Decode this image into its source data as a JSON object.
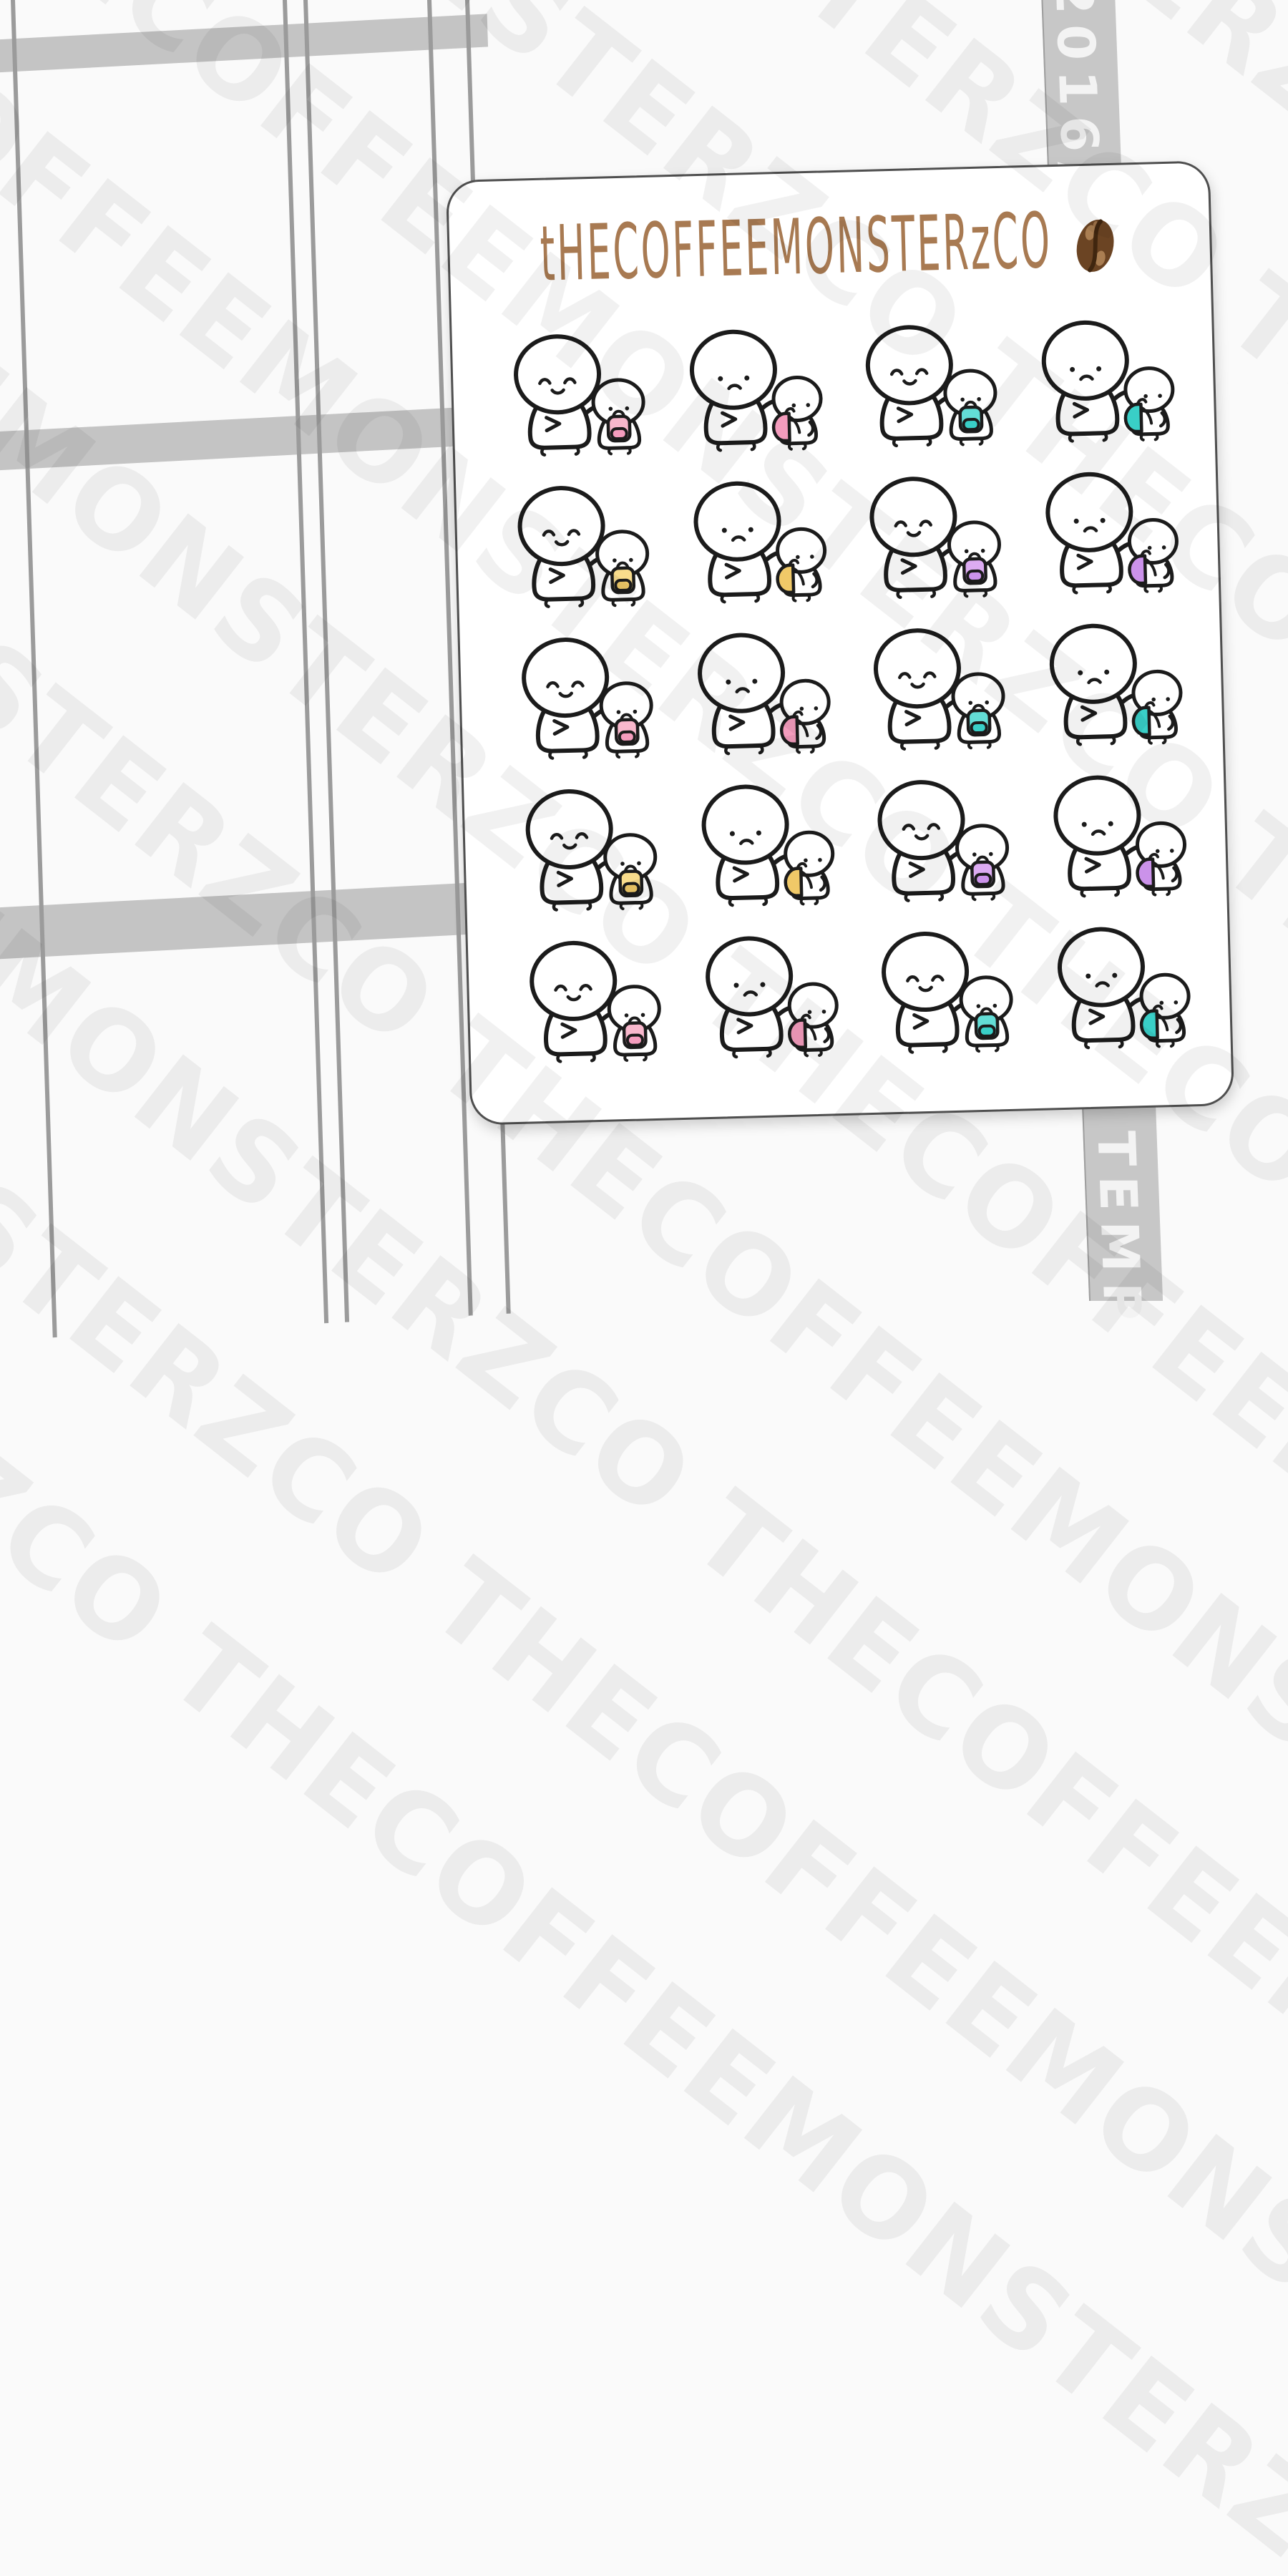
{
  "watermark": {
    "text": "THECOFFEEMONSTERZCO",
    "color": "rgba(0,0,0,0.053)"
  },
  "background_planner": {
    "band_color": "#c4c4c4",
    "line_color": "#9b9b9b"
  },
  "ribbon": {
    "color": "#c7c7c7",
    "edge_color": "#9e9e9e",
    "text_color": "#f3f3f3",
    "top_text": "2016/9/2",
    "bottom_text": "TEMP"
  },
  "sheet": {
    "background": "#ffffff",
    "border_color": "#4f4f4f",
    "logo": {
      "text": "tHECOFFEEMONSTERzCO",
      "color": "#a87a52",
      "bean_icon": "coffee-bean-icon",
      "bean_colors": {
        "body": "#6b4423",
        "crease": "#40260f",
        "spot": "#b5885a"
      }
    },
    "palette": {
      "pink": {
        "main": "#f8b7cc",
        "shade": "#f49cbd"
      },
      "teal": {
        "main": "#63ddd6",
        "shade": "#39cfc7"
      },
      "yellow": {
        "main": "#f8dc8c",
        "shade": "#f0c968"
      },
      "purple": {
        "main": "#dcabf2",
        "shade": "#cb92ea"
      }
    },
    "outline_color": "#1b1b1b",
    "character_fill": "#ffffff",
    "rows": [
      [
        {
          "color": "pink",
          "pose": "front",
          "mood": "happy"
        },
        {
          "color": "pink",
          "pose": "side",
          "mood": "sad"
        },
        {
          "color": "teal",
          "pose": "front",
          "mood": "happy"
        },
        {
          "color": "teal",
          "pose": "side",
          "mood": "sad"
        }
      ],
      [
        {
          "color": "yellow",
          "pose": "front",
          "mood": "happy"
        },
        {
          "color": "yellow",
          "pose": "side",
          "mood": "sad"
        },
        {
          "color": "purple",
          "pose": "front",
          "mood": "happy"
        },
        {
          "color": "purple",
          "pose": "side",
          "mood": "sad"
        }
      ],
      [
        {
          "color": "pink",
          "pose": "front",
          "mood": "happy"
        },
        {
          "color": "pink",
          "pose": "side",
          "mood": "sad"
        },
        {
          "color": "teal",
          "pose": "front",
          "mood": "happy"
        },
        {
          "color": "teal",
          "pose": "side",
          "mood": "sad"
        }
      ],
      [
        {
          "color": "yellow",
          "pose": "front",
          "mood": "happy"
        },
        {
          "color": "yellow",
          "pose": "side",
          "mood": "sad"
        },
        {
          "color": "purple",
          "pose": "front",
          "mood": "happy"
        },
        {
          "color": "purple",
          "pose": "side",
          "mood": "sad"
        }
      ],
      [
        {
          "color": "pink",
          "pose": "front",
          "mood": "happy"
        },
        {
          "color": "pink",
          "pose": "side",
          "mood": "sad"
        },
        {
          "color": "teal",
          "pose": "front",
          "mood": "happy"
        },
        {
          "color": "teal",
          "pose": "side",
          "mood": "sad"
        }
      ]
    ]
  }
}
